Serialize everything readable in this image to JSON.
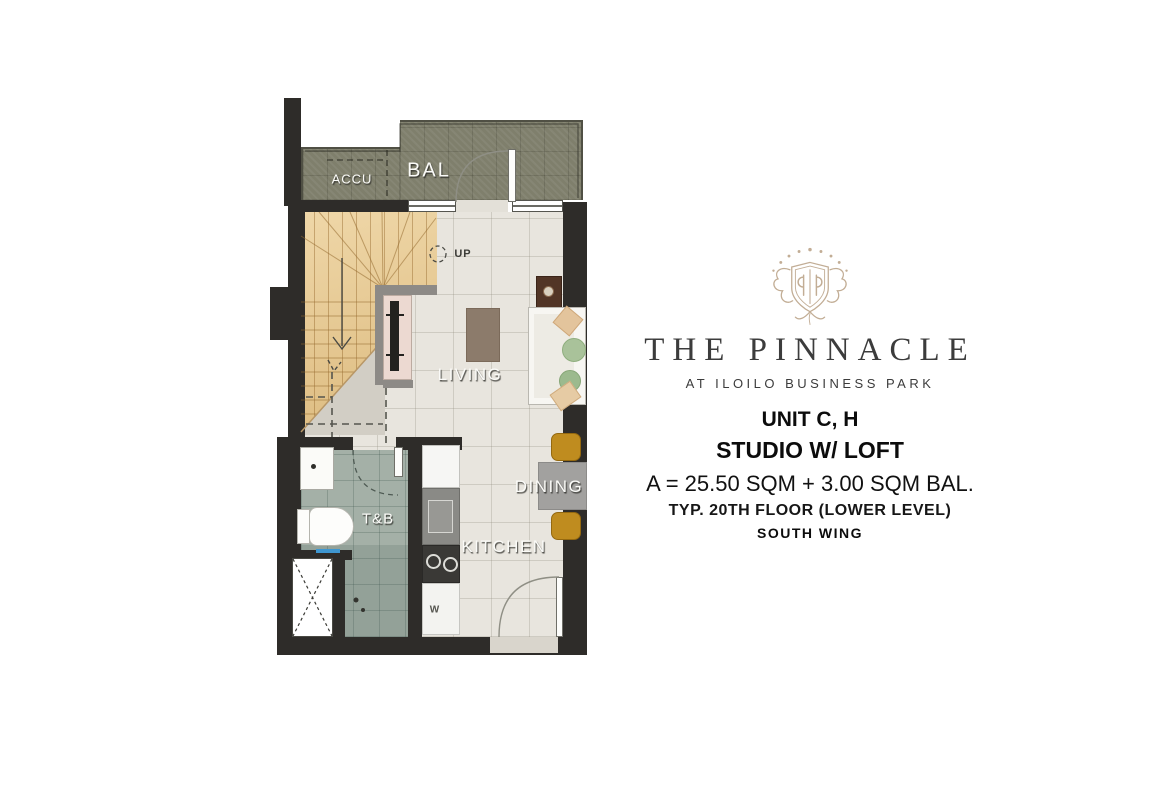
{
  "plan": {
    "labels": {
      "balcony": "BAL",
      "accu": "ACCU",
      "up": "UP",
      "living": "LIVING",
      "dining": "DINING",
      "kitchen": "KITCHEN",
      "toilet_bath": "T&B",
      "washer": "W"
    },
    "colors": {
      "wall": "#2e2c29",
      "balcony_deck": "#7f7f6c",
      "unit_floor": "#e8e5de",
      "bath_tile": "#a4b0a7",
      "stair_wood": "#e7cc96",
      "loft_wall": "#8d8a86",
      "dining_chair": "#bf8c1f",
      "dining_table": "#a2a19f",
      "sofa": "#f7f6f2",
      "console_wood": "#523526",
      "coffee_table": "#8c7b6b",
      "brand_gold": "#c2ad95"
    }
  },
  "info": {
    "brand": "THE PINNACLE",
    "tagline": "AT ILOILO BUSINESS PARK",
    "unit": "UNIT C, H",
    "unit_type": "STUDIO W/ LOFT",
    "area": "A = 25.50 SQM + 3.00 SQM BAL.",
    "floor": "TYP. 20TH FLOOR (LOWER LEVEL)",
    "wing": "SOUTH WING"
  }
}
